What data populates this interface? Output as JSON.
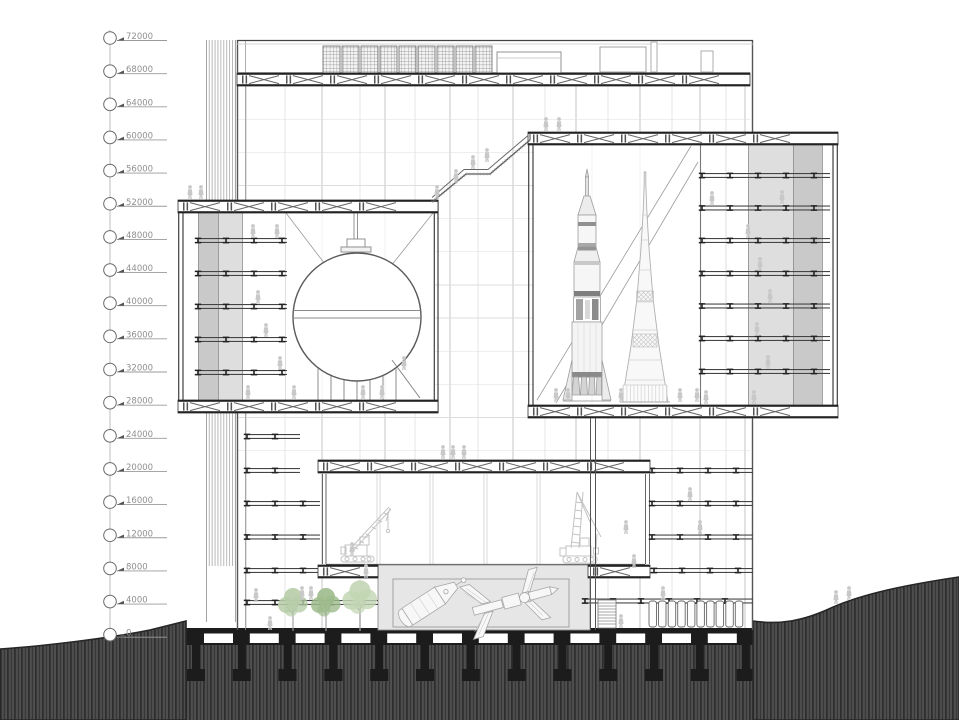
{
  "drawing": {
    "type": "architectural-cross-section",
    "elevation_scale": {
      "unit_step": 4000,
      "levels": [
        "72000",
        "68000",
        "64000",
        "60000",
        "56000",
        "52000",
        "48000",
        "44000",
        "40000",
        "36000",
        "32000",
        "28000",
        "24000",
        "20000",
        "16000",
        "12000",
        "8000",
        "4000",
        "0"
      ]
    },
    "depicted_elements": [
      "elevation-scale",
      "service-core",
      "roof-equipment",
      "main-truss",
      "sphere-hall",
      "planetarium-sphere",
      "rocket-hall",
      "saturn-v-rocket",
      "n1-rocket",
      "gallery-floors",
      "access-ramp",
      "exhibition-hall",
      "crawler-crane-left",
      "crawler-crane-right",
      "exhibit-basin",
      "apollo-spacecraft-exhibit",
      "space-station-exhibit",
      "stairs",
      "locker-doors",
      "trees",
      "human-figures",
      "foundation-piles",
      "terrain"
    ]
  },
  "colors": {
    "label": "#8f8f8f",
    "ink": "#3a3a3a",
    "grid": "#c9c9c9",
    "grid_light": "#e4e4e4",
    "figure": "#c8c8c8",
    "band_light": "#dedede",
    "band_dark": "#c9c9c9",
    "basin": "#e6e6e6",
    "sketch": "#c3c3c3",
    "terrain_base": "#404040",
    "terrain_dark": "#2f2f2f",
    "terrain_light": "#5a5a5a",
    "foundation": "#1c1c1c",
    "tree_soft": "#b7cda8",
    "tree_mid": "#9dbb8c",
    "tree_light": "#c2d6b4"
  }
}
